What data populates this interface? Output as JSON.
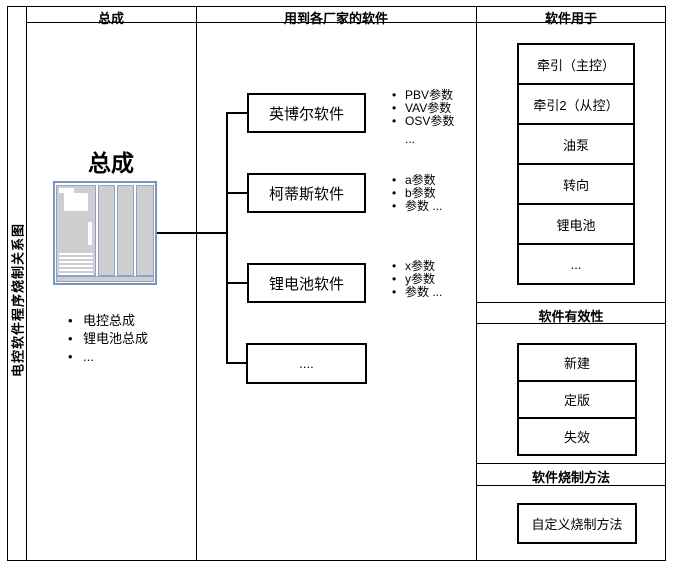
{
  "side_label": "电控软件程序烧制关系图",
  "assembly": {
    "header": "总成",
    "title": "总成",
    "items": [
      "电控总成",
      "锂电池总成",
      "..."
    ]
  },
  "vendors": {
    "header": "用到各厂家的软件",
    "nodes": [
      {
        "label": "英博尔软件",
        "params": [
          "PBV参数",
          "VAV参数",
          "OSV参数",
          "..."
        ]
      },
      {
        "label": "柯蒂斯软件",
        "params": [
          "a参数",
          "b参数",
          "参数 ..."
        ]
      },
      {
        "label": "锂电池软件",
        "params": [
          "x参数",
          "y参数",
          "参数 ..."
        ]
      },
      {
        "label": "...."
      }
    ]
  },
  "usage": {
    "header": "软件用于",
    "targets": [
      "牵引（主控）",
      "牵引2（从控）",
      "油泵",
      "转向",
      "锂电池",
      "..."
    ]
  },
  "validity": {
    "header": "软件有效性",
    "states": [
      "新建",
      "定版",
      "失效"
    ]
  },
  "burn": {
    "header": "软件烧制方法",
    "method": "自定义烧制方法"
  }
}
